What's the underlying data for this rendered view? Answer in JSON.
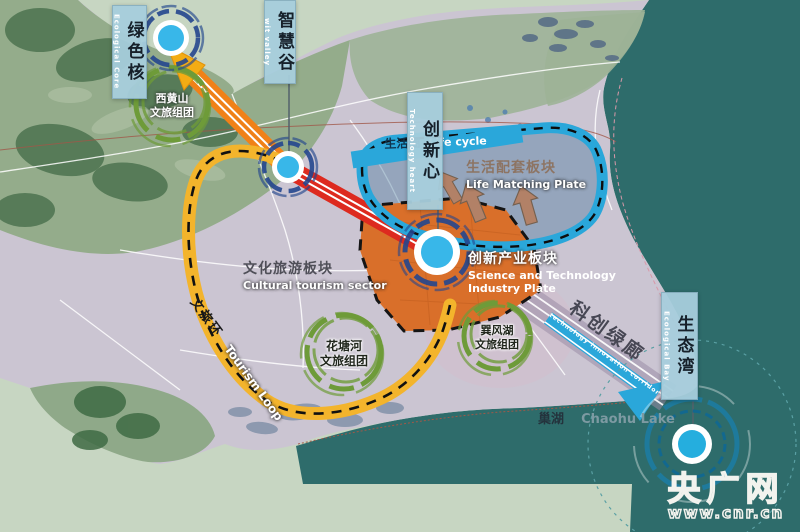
{
  "banners": {
    "green_core": {
      "zh": "绿色核",
      "en": "Ecological Core"
    },
    "wit_valley": {
      "zh": "智慧谷",
      "en": "wit valley"
    },
    "innovation_heart": {
      "zh": "创新心",
      "en": "Technology heart"
    },
    "ecological_bay": {
      "zh": "生态湾",
      "en": "Ecological Bay"
    }
  },
  "zones": {
    "cultural": {
      "zh": "文化旅游板块",
      "en": "Cultural tourism sector"
    },
    "life": {
      "zh": "生活配套板块",
      "en": "Life Matching Plate"
    },
    "sci": {
      "zh": "创新产业板块",
      "en1": "Science and Technology",
      "en2": "Industry Plate"
    }
  },
  "clusters": {
    "xihuangshan": {
      "l1": "西黄山",
      "l2": "文旅组团"
    },
    "huatanghe": {
      "l1": "花塘河",
      "l2": "文旅组团"
    },
    "xunfenghu": {
      "l1": "巽风湖",
      "l2": "文旅组团"
    }
  },
  "corridors": {
    "tourism_loop": {
      "zh": "文旅环",
      "en": "Tourism Loop"
    },
    "sci_green": {
      "zh": "科创绿廊",
      "small_text": "technology innovation corridor"
    },
    "life_cycle": {
      "zh": "生活圈",
      "en": "Life cycle"
    }
  },
  "lake": {
    "zh": "巢湖",
    "en": "Chaohu Lake"
  },
  "watermark": {
    "name": "央广网",
    "url": "www.cnr.cn"
  },
  "colors": {
    "lake_teal": "#2e6c6b",
    "shore_sage": "#c7d6c2",
    "plain": "#cbc5d2",
    "mountain": "#94ac8b",
    "orange_zone": "#d96f2a",
    "red_corridor": "#dd2a1f",
    "orange_corridor": "#f08118",
    "yellow_loop": "#f3b42c",
    "cyan": "#2aa7da",
    "banner_blue": "#a7cddc",
    "node_blue": "#38b7e9",
    "node_ring": "#24468e",
    "cluster_green": "#6e9b39",
    "arrow_brown": "#b28167"
  }
}
